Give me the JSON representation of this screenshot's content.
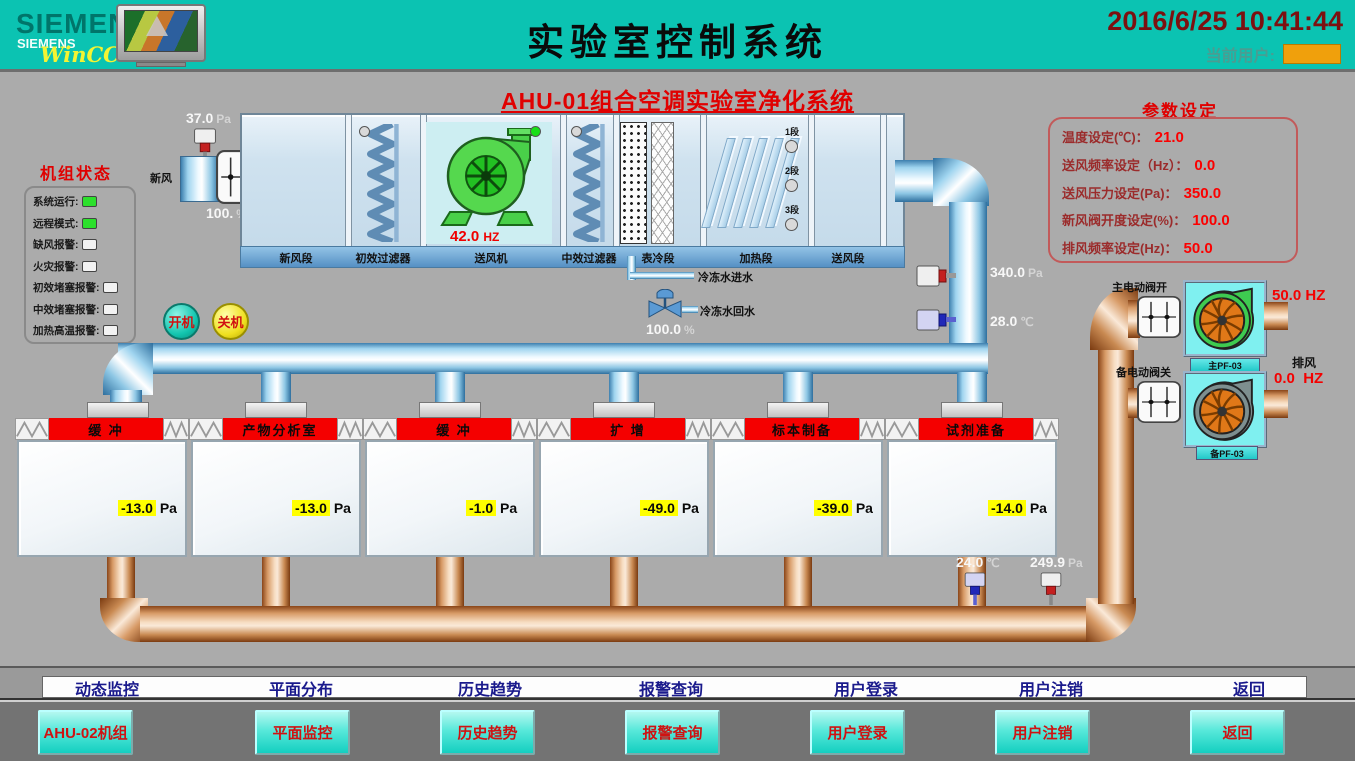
{
  "header": {
    "brand_big": "SIEMENS",
    "brand_small": "SIEMENS",
    "brand_wincc": "WinCC",
    "title": "实验室控制系统",
    "datetime": "2016/6/25 10:41:44",
    "current_user_label": "当前用户:"
  },
  "subtitle": "AHU-01组合空调实验室净化系统",
  "colors": {
    "header_teal": "#0bc3b2",
    "alarm_red": "#e00000",
    "value_red": "#fb0000",
    "indicator_green": "#2ce02c",
    "tag_yellow": "#ffff00",
    "banner_red": "#f40000",
    "user_box_orange": "#f0a00c",
    "nav_button_cyan": "#14cfc0"
  },
  "unit_status": {
    "title": "机组状态",
    "items": [
      {
        "label": "系统运行:",
        "state": "on"
      },
      {
        "label": "远程模式:",
        "state": "on"
      },
      {
        "label": "缺风报警:",
        "state": "off"
      },
      {
        "label": "火灾报警:",
        "state": "off"
      },
      {
        "label": "初效堵塞报警:",
        "state": "off"
      },
      {
        "label": "中效堵塞报警:",
        "state": "off"
      },
      {
        "label": "加热高温报警:",
        "state": "off"
      }
    ]
  },
  "params": {
    "title": "参数设定",
    "items": [
      {
        "label": "温度设定(℃)：",
        "value": "21.0"
      },
      {
        "label": "送风频率设定（Hz）：",
        "value": "0.0"
      },
      {
        "label": "送风压力设定(Pa)：",
        "value": "350.0"
      },
      {
        "label": "新风阀开度设定(%)：",
        "value": "100.0"
      },
      {
        "label": "排风频率设定(Hz)：",
        "value": "50.0"
      }
    ]
  },
  "ahu": {
    "sections": [
      "新风段",
      "初效过滤器",
      "送风机",
      "中效过滤器",
      "表冷段",
      "加热段",
      "送风段"
    ],
    "supply_fan_freq": {
      "value": "42.0",
      "unit": "HZ"
    },
    "heater_stages": [
      {
        "label": "1段",
        "state": "off"
      },
      {
        "label": "2段",
        "state": "off"
      },
      {
        "label": "3段",
        "state": "off"
      }
    ],
    "indicators": {
      "prefilter": "off",
      "supply_fan": "on",
      "midfilter": "off"
    },
    "fresh_air_label": "新风",
    "inlet_pressure": {
      "value": "37.0",
      "unit": "Pa"
    },
    "inlet_damper_opening": {
      "value": "100.",
      "unit": "%"
    },
    "supply_pressure": {
      "value": "340.0",
      "unit": "Pa"
    },
    "supply_temp": {
      "value": "28.0",
      "unit": "℃"
    },
    "chilled_in_label": "冷冻水进水",
    "chilled_out_label": "冷冻水回水",
    "valve_opening": {
      "value": "100.0",
      "unit": "%"
    }
  },
  "controls": {
    "start": "开机",
    "stop": "关机"
  },
  "rooms": [
    {
      "name": "缓 冲",
      "pressure": "-13.0",
      "unit": "Pa"
    },
    {
      "name": "产物分析室",
      "pressure": "-13.0",
      "unit": "Pa"
    },
    {
      "name": "缓 冲",
      "pressure": "-1.0",
      "unit": "Pa"
    },
    {
      "name": "扩 增",
      "pressure": "-49.0",
      "unit": "Pa"
    },
    {
      "name": "标本制备",
      "pressure": "-39.0",
      "unit": "Pa"
    },
    {
      "name": "试剂准备",
      "pressure": "-14.0",
      "unit": "Pa"
    }
  ],
  "exhaust": {
    "main_valve_label": "主电动阀开",
    "backup_valve_label": "备电动阀关",
    "exhaust_label": "排风",
    "main_fan": {
      "name": "主PF-03",
      "freq": "50.0",
      "unit": "HZ",
      "state": "running"
    },
    "backup_fan": {
      "name": "备PF-03",
      "freq": "0.0",
      "unit": "HZ",
      "state": "stopped"
    },
    "return_temp": {
      "value": "24.0",
      "unit": "℃"
    },
    "return_pressure": {
      "value": "249.9",
      "unit": "Pa"
    }
  },
  "menu": [
    "动态监控",
    "平面分布",
    "历史趋势",
    "报警查询",
    "用户登录",
    "用户注销",
    "返回"
  ],
  "nav_buttons": [
    "AHU-02机组",
    "平面监控",
    "历史趋势",
    "报警查询",
    "用户登录",
    "用户注销",
    "返回"
  ]
}
